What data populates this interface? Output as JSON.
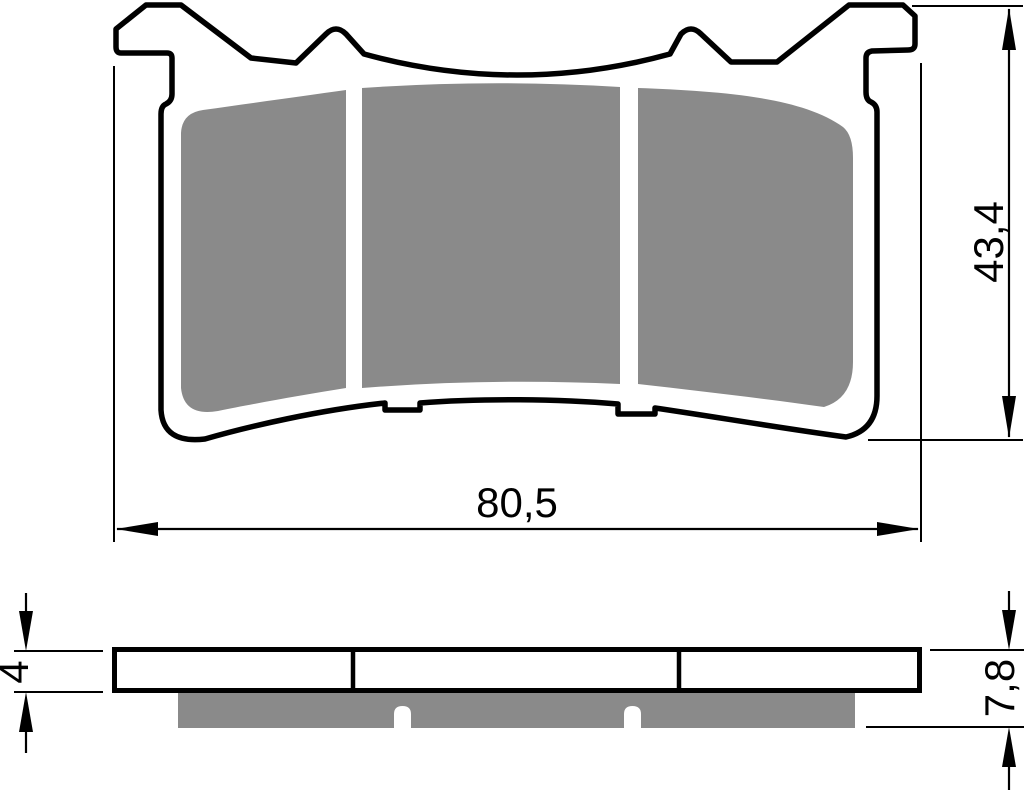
{
  "drawing": {
    "subject": "brake pad technical drawing",
    "dimensions": {
      "overall_width": "80,5",
      "overall_height": "43,4",
      "backplate_thickness": "4",
      "overall_thickness": "7,8"
    },
    "colors": {
      "line": "#000000",
      "friction": "#8a8a8a",
      "plate": "#ffffff",
      "background": "#ffffff"
    }
  }
}
